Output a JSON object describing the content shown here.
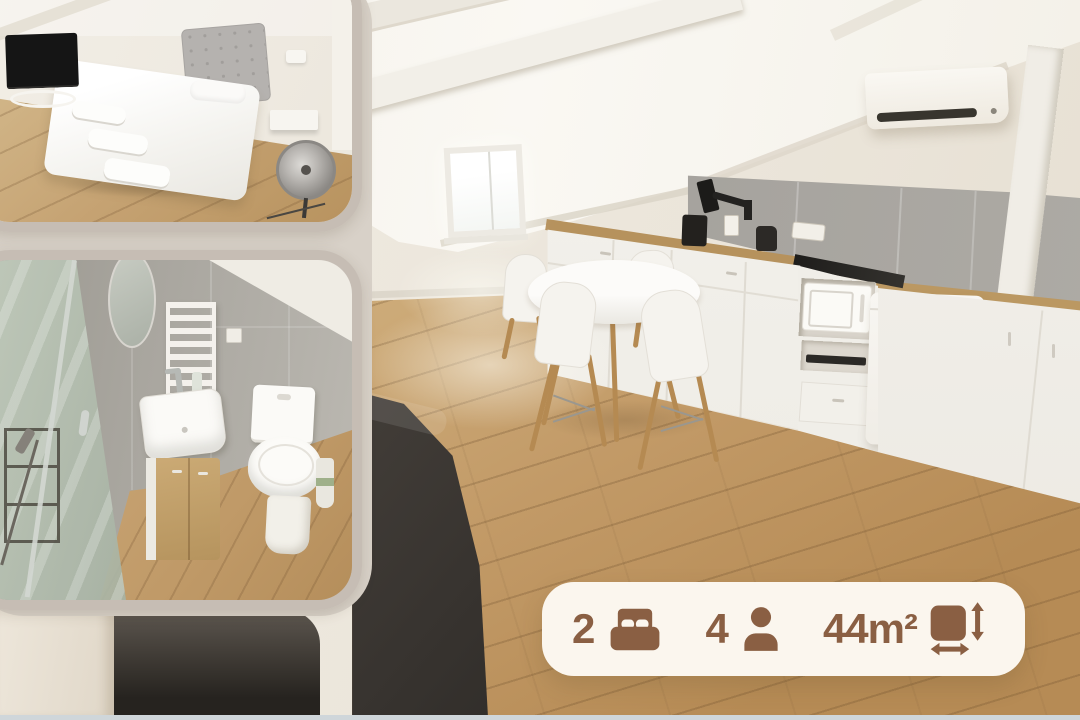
{
  "card": {
    "badge": {
      "background_color": "#FBF6EE",
      "accent_color": "#8A5F43",
      "stats": [
        {
          "value": "2",
          "icon": "bed-icon"
        },
        {
          "value": "4",
          "icon": "person-icon"
        },
        {
          "value": "44m²",
          "icon": "area-icon"
        }
      ]
    }
  }
}
